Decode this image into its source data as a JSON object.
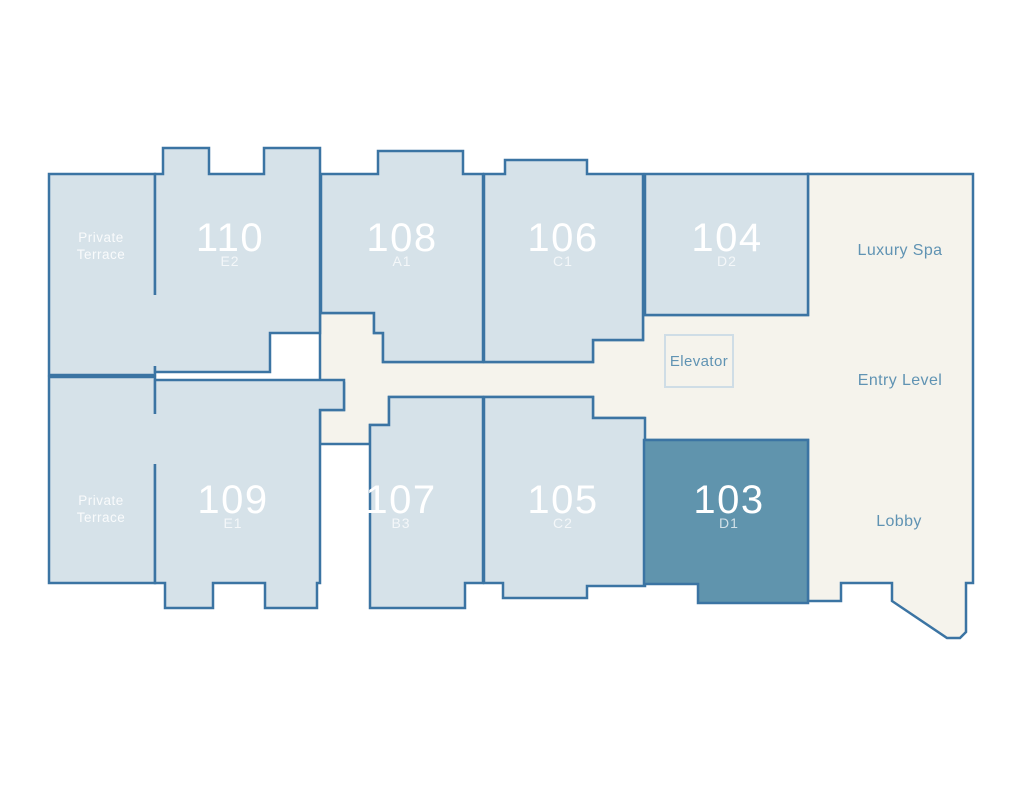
{
  "colors": {
    "background": "#ffffff",
    "unit_fill": "#d6e2e9",
    "unit_highlight": "#6094ad",
    "common_fill": "#f5f3ec",
    "wall": "#3b74a3",
    "elevator_border": "#cfdde6",
    "label_text": "#6093b3",
    "unit_text": "#ffffff"
  },
  "floorplan": {
    "terrace_top": {
      "line1": "Private",
      "line2": "Terrace"
    },
    "terrace_bottom": {
      "line1": "Private",
      "line2": "Terrace"
    },
    "units": [
      {
        "number": "110",
        "code": "E2"
      },
      {
        "number": "108",
        "code": "A1"
      },
      {
        "number": "106",
        "code": "C1"
      },
      {
        "number": "104",
        "code": "D2"
      },
      {
        "number": "109",
        "code": "E1"
      },
      {
        "number": "107",
        "code": "B3"
      },
      {
        "number": "105",
        "code": "C2"
      },
      {
        "number": "103",
        "code": "D1"
      }
    ],
    "common_areas": {
      "luxury_spa": "Luxury Spa",
      "entry_level": "Entry Level",
      "lobby": "Lobby",
      "elevator": "Elevator"
    }
  }
}
